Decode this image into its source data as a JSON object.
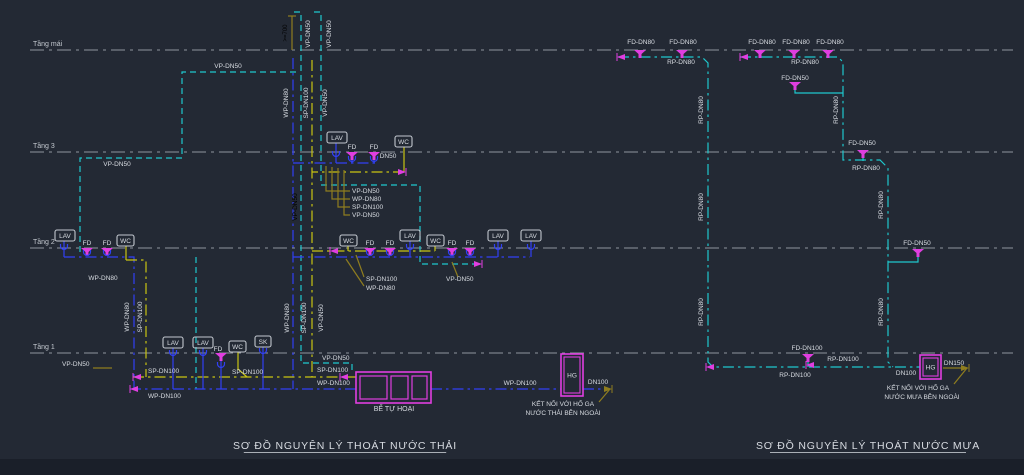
{
  "canvas": {
    "w": 1024,
    "h": 475,
    "bg": "#232934",
    "bottom_bar": {
      "y": 459,
      "h": 16,
      "color": "#1a1f29"
    }
  },
  "colors": {
    "cy": "#1ec8cd",
    "bl": "#3140f5",
    "yl": "#c9c412",
    "mg": "#e03ee0",
    "ol": "#8f7d1f",
    "w": "#d8dce2",
    "gr": "#8f959e",
    "grt": "#c3c8cf"
  },
  "dashes": {
    "d": "6,4",
    "dd": "11,4,2.5,4",
    "floor": "14,5,3,5"
  },
  "floors": [
    {
      "label": "Tầng mái",
      "y": 50
    },
    {
      "label": "Tầng 3",
      "y": 152
    },
    {
      "label": "Tầng 2",
      "y": 248
    },
    {
      "label": "Tầng 1",
      "y": 353
    }
  ],
  "titles": [
    {
      "t": "SƠ ĐỒ NGUYÊN LÝ THOÁT NƯỚC THẢI",
      "x": 345,
      "y": 449
    },
    {
      "t": "SƠ ĐỒ NGUYÊN LÝ THOÁT NƯỚC MƯA",
      "x": 868,
      "y": 449
    }
  ],
  "pipes": [
    {
      "c": "cy",
      "d": "d",
      "pts": [
        [
          294,
          12
        ],
        [
          301,
          12
        ],
        [
          301,
          363
        ],
        [
          352,
          363
        ],
        [
          352,
          372
        ]
      ]
    },
    {
      "c": "cy",
      "d": "d",
      "pts": [
        [
          314,
          12
        ],
        [
          321,
          12
        ],
        [
          321,
          185
        ]
      ]
    },
    {
      "c": "cy",
      "d": "d",
      "pts": [
        [
          321,
          185
        ],
        [
          420,
          185
        ],
        [
          420,
          264
        ],
        [
          480,
          264
        ]
      ]
    },
    {
      "c": "cy",
      "d": "d",
      "pts": [
        [
          296,
          72
        ],
        [
          182,
          72
        ],
        [
          182,
          158
        ],
        [
          80,
          158
        ],
        [
          80,
          252
        ]
      ]
    },
    {
      "c": "cy",
      "d": "d",
      "pts": [
        [
          196,
          257
        ],
        [
          196,
          389
        ]
      ]
    },
    {
      "c": "bl",
      "d": "dd",
      "pts": [
        [
          293,
          58
        ],
        [
          293,
          389
        ]
      ]
    },
    {
      "c": "yl",
      "d": "dd",
      "pts": [
        [
          312,
          60
        ],
        [
          312,
          377
        ]
      ]
    },
    {
      "c": "bl",
      "d": "dd",
      "pts": [
        [
          293,
          163
        ],
        [
          378,
          163
        ]
      ]
    },
    {
      "c": "bl",
      "d": "s",
      "pts": [
        [
          336,
          143
        ],
        [
          336,
          163
        ]
      ]
    },
    {
      "c": "bl",
      "d": "s",
      "pts": [
        [
          352,
          158
        ],
        [
          352,
          163
        ]
      ]
    },
    {
      "c": "bl",
      "d": "s",
      "pts": [
        [
          374,
          158
        ],
        [
          374,
          163
        ]
      ]
    },
    {
      "c": "yl",
      "d": "s",
      "pts": [
        [
          404,
          147
        ],
        [
          404,
          172
        ]
      ]
    },
    {
      "c": "yl",
      "d": "dd",
      "pts": [
        [
          404,
          172
        ],
        [
          312,
          172
        ]
      ]
    },
    {
      "c": "bl",
      "d": "s",
      "pts": [
        [
          64,
          241
        ],
        [
          64,
          257
        ]
      ]
    },
    {
      "c": "bl",
      "d": "dd",
      "pts": [
        [
          64,
          257
        ],
        [
          134,
          257
        ],
        [
          134,
          389
        ]
      ]
    },
    {
      "c": "yl",
      "d": "s",
      "pts": [
        [
          126,
          246
        ],
        [
          126,
          260
        ]
      ]
    },
    {
      "c": "yl",
      "d": "dd",
      "pts": [
        [
          126,
          260
        ],
        [
          146,
          260
        ],
        [
          146,
          377
        ]
      ]
    },
    {
      "c": "bl",
      "d": "dd",
      "pts": [
        [
          293,
          257
        ],
        [
          530,
          257
        ]
      ]
    },
    {
      "c": "bl",
      "d": "s",
      "pts": [
        [
          410,
          241
        ],
        [
          410,
          257
        ]
      ]
    },
    {
      "c": "bl",
      "d": "s",
      "pts": [
        [
          498,
          241
        ],
        [
          498,
          257
        ]
      ]
    },
    {
      "c": "bl",
      "d": "s",
      "pts": [
        [
          531,
          241
        ],
        [
          531,
          257
        ]
      ]
    },
    {
      "c": "yl",
      "d": "s",
      "pts": [
        [
          348,
          246
        ],
        [
          348,
          251
        ]
      ]
    },
    {
      "c": "yl",
      "d": "s",
      "pts": [
        [
          435,
          246
        ],
        [
          435,
          251
        ]
      ]
    },
    {
      "c": "yl",
      "d": "dd",
      "pts": [
        [
          312,
          251
        ],
        [
          435,
          251
        ]
      ]
    },
    {
      "c": "yl",
      "d": "dd",
      "pts": [
        [
          133,
          377
        ],
        [
          356,
          377
        ]
      ]
    },
    {
      "c": "bl",
      "d": "dd",
      "pts": [
        [
          130,
          389
        ],
        [
          356,
          389
        ]
      ]
    },
    {
      "c": "yl",
      "d": "s",
      "pts": [
        [
          238,
          352
        ],
        [
          238,
          369
        ],
        [
          247,
          377
        ]
      ]
    },
    {
      "c": "bl",
      "d": "s",
      "pts": [
        [
          263,
          347
        ],
        [
          263,
          389
        ]
      ]
    },
    {
      "c": "bl",
      "d": "s",
      "pts": [
        [
          173,
          348
        ],
        [
          173,
          389
        ]
      ]
    },
    {
      "c": "bl",
      "d": "s",
      "pts": [
        [
          203,
          348
        ],
        [
          203,
          389
        ]
      ]
    },
    {
      "c": "bl",
      "d": "s",
      "pts": [
        [
          221,
          361
        ],
        [
          221,
          389
        ]
      ]
    },
    {
      "c": "bl",
      "d": "dd",
      "pts": [
        [
          431,
          389
        ],
        [
          561,
          389
        ]
      ]
    },
    {
      "c": "bl",
      "d": "dd",
      "pts": [
        [
          583,
          389
        ],
        [
          610,
          389
        ]
      ]
    },
    {
      "c": "ol",
      "d": "s",
      "pts": [
        [
          610,
          389
        ],
        [
          599,
          402
        ]
      ]
    },
    {
      "c": "ol",
      "d": "s",
      "pts": [
        [
          292,
          16
        ],
        [
          292,
          50
        ]
      ]
    },
    {
      "c": "ol",
      "d": "s",
      "pts": [
        [
          288,
          16
        ],
        [
          296,
          16
        ]
      ]
    },
    {
      "c": "ol",
      "d": "s",
      "pts": [
        [
          350,
          191
        ],
        [
          326,
          191
        ],
        [
          326,
          166
        ]
      ]
    },
    {
      "c": "ol",
      "d": "s",
      "pts": [
        [
          350,
          199
        ],
        [
          332,
          199
        ],
        [
          332,
          167
        ]
      ]
    },
    {
      "c": "ol",
      "d": "s",
      "pts": [
        [
          350,
          207
        ],
        [
          338,
          207
        ],
        [
          338,
          168
        ]
      ]
    },
    {
      "c": "ol",
      "d": "s",
      "pts": [
        [
          350,
          215
        ],
        [
          344,
          215
        ],
        [
          344,
          170
        ]
      ]
    },
    {
      "c": "ol",
      "d": "s",
      "pts": [
        [
          364,
          277
        ],
        [
          356,
          255
        ]
      ]
    },
    {
      "c": "ol",
      "d": "s",
      "pts": [
        [
          364,
          286
        ],
        [
          346,
          259
        ]
      ]
    },
    {
      "c": "ol",
      "d": "s",
      "pts": [
        [
          458,
          277
        ],
        [
          452,
          262
        ]
      ]
    },
    {
      "c": "ol",
      "d": "s",
      "pts": [
        [
          93,
          368
        ],
        [
          112,
          368
        ]
      ]
    },
    {
      "c": "cy",
      "d": "dd",
      "pts": [
        [
          618,
          57
        ],
        [
          702,
          57
        ],
        [
          708,
          63
        ],
        [
          708,
          362
        ],
        [
          713,
          367
        ],
        [
          920,
          367
        ]
      ]
    },
    {
      "c": "cy",
      "d": "dd",
      "pts": [
        [
          740,
          57
        ],
        [
          838,
          57
        ],
        [
          843,
          62
        ],
        [
          843,
          160
        ],
        [
          880,
          160
        ],
        [
          888,
          168
        ],
        [
          888,
          362
        ],
        [
          893,
          367
        ]
      ]
    },
    {
      "c": "cy",
      "d": "s",
      "pts": [
        [
          795,
          90
        ],
        [
          795,
          93
        ],
        [
          843,
          93
        ]
      ]
    },
    {
      "c": "cy",
      "d": "s",
      "pts": [
        [
          863,
          158
        ],
        [
          863,
          161
        ]
      ]
    },
    {
      "c": "cy",
      "d": "s",
      "pts": [
        [
          918,
          257
        ],
        [
          918,
          262
        ],
        [
          888,
          262
        ]
      ]
    },
    {
      "c": "cy",
      "d": "s",
      "pts": [
        [
          808,
          362
        ],
        [
          808,
          367
        ]
      ]
    },
    {
      "c": "ol",
      "d": "s",
      "pts": [
        [
          943,
          368
        ],
        [
          967,
          368
        ]
      ]
    },
    {
      "c": "ol",
      "d": "s",
      "pts": [
        [
          967,
          368
        ],
        [
          954,
          384
        ]
      ]
    }
  ],
  "funnels": [
    {
      "x": 352,
      "y": 152
    },
    {
      "x": 374,
      "y": 152
    },
    {
      "x": 87,
      "y": 248
    },
    {
      "x": 107,
      "y": 248
    },
    {
      "x": 370,
      "y": 248
    },
    {
      "x": 390,
      "y": 248
    },
    {
      "x": 452,
      "y": 248
    },
    {
      "x": 470,
      "y": 248
    },
    {
      "x": 221,
      "y": 353
    },
    {
      "x": 640,
      "y": 50
    },
    {
      "x": 682,
      "y": 50
    },
    {
      "x": 760,
      "y": 50
    },
    {
      "x": 794,
      "y": 50
    },
    {
      "x": 828,
      "y": 50
    },
    {
      "x": 795,
      "y": 82
    },
    {
      "x": 863,
      "y": 150
    },
    {
      "x": 918,
      "y": 249
    },
    {
      "x": 808,
      "y": 354
    }
  ],
  "traps": [
    {
      "x": 336,
      "y": 153
    },
    {
      "x": 352,
      "y": 158
    },
    {
      "x": 374,
      "y": 158
    },
    {
      "x": 64,
      "y": 246
    },
    {
      "x": 87,
      "y": 252
    },
    {
      "x": 107,
      "y": 252
    },
    {
      "x": 370,
      "y": 252
    },
    {
      "x": 390,
      "y": 252
    },
    {
      "x": 410,
      "y": 246
    },
    {
      "x": 452,
      "y": 252
    },
    {
      "x": 470,
      "y": 252
    },
    {
      "x": 498,
      "y": 246
    },
    {
      "x": 531,
      "y": 246
    },
    {
      "x": 173,
      "y": 352
    },
    {
      "x": 203,
      "y": 352
    },
    {
      "x": 263,
      "y": 350
    },
    {
      "x": 221,
      "y": 364
    }
  ],
  "arrows": [
    {
      "x": 406,
      "y": 172,
      "d": "r"
    },
    {
      "x": 330,
      "y": 251,
      "d": "l"
    },
    {
      "x": 482,
      "y": 264,
      "d": "r"
    },
    {
      "x": 133,
      "y": 377,
      "d": "l"
    },
    {
      "x": 130,
      "y": 389,
      "d": "l"
    },
    {
      "x": 340,
      "y": 377,
      "d": "l"
    },
    {
      "x": 617,
      "y": 57,
      "d": "l"
    },
    {
      "x": 740,
      "y": 57,
      "d": "l"
    },
    {
      "x": 706,
      "y": 367,
      "d": "l"
    },
    {
      "x": 806,
      "y": 365,
      "d": "l"
    },
    {
      "x": 612,
      "y": 389,
      "d": "r",
      "c": "ol"
    },
    {
      "x": 969,
      "y": 368,
      "d": "r",
      "c": "ol"
    }
  ],
  "boxes": [
    {
      "t": "LAV",
      "x": 327,
      "y": 132,
      "w": 20
    },
    {
      "t": "WC",
      "x": 395,
      "y": 136,
      "w": 17
    },
    {
      "t": "LAV",
      "x": 55,
      "y": 230,
      "w": 20
    },
    {
      "t": "WC",
      "x": 117,
      "y": 235,
      "w": 17
    },
    {
      "t": "WC",
      "x": 340,
      "y": 235,
      "w": 17
    },
    {
      "t": "LAV",
      "x": 400,
      "y": 230,
      "w": 20
    },
    {
      "t": "WC",
      "x": 427,
      "y": 235,
      "w": 17
    },
    {
      "t": "LAV",
      "x": 488,
      "y": 230,
      "w": 20
    },
    {
      "t": "LAV",
      "x": 521,
      "y": 230,
      "w": 20
    },
    {
      "t": "LAV",
      "x": 163,
      "y": 337,
      "w": 20
    },
    {
      "t": "LAV",
      "x": 193,
      "y": 337,
      "w": 20
    },
    {
      "t": "WC",
      "x": 229,
      "y": 341,
      "w": 17
    },
    {
      "t": "SK",
      "x": 255,
      "y": 336,
      "w": 16
    }
  ],
  "tank": {
    "x": 356,
    "y": 372,
    "w": 75,
    "h": 31,
    "label": "BỂ TỰ HOẠI",
    "cells": [
      [
        360,
        376,
        27,
        23
      ],
      [
        391,
        376,
        17,
        23
      ],
      [
        412,
        376,
        15,
        23
      ]
    ]
  },
  "manholes": [
    {
      "x": 561,
      "y": 354,
      "w": 22,
      "h": 42,
      "label": "HG"
    },
    {
      "x": 920,
      "y": 355,
      "w": 21,
      "h": 24,
      "label": "HG"
    }
  ],
  "labels": [
    {
      "t": ">=700",
      "x": 287,
      "y": 33,
      "r": -90,
      "c": "ol",
      "fs": 6
    },
    {
      "t": "VP-DN50",
      "x": 310,
      "y": 34,
      "r": -90
    },
    {
      "t": "VP-DN50",
      "x": 331,
      "y": 34,
      "r": -90
    },
    {
      "t": "VP-DN50",
      "x": 228,
      "y": 68
    },
    {
      "t": "WP-DN80",
      "x": 288,
      "y": 103,
      "r": -90
    },
    {
      "t": "SP-DN100",
      "x": 308,
      "y": 103,
      "r": -90
    },
    {
      "t": "VP-DN50",
      "x": 327,
      "y": 103,
      "r": -90
    },
    {
      "t": "VP-DN50",
      "x": 117,
      "y": 166
    },
    {
      "t": "VP-DN50",
      "x": 297,
      "y": 207,
      "r": -90,
      "c": "cy"
    },
    {
      "t": "FD",
      "x": 352,
      "y": 149
    },
    {
      "t": "FD",
      "x": 374,
      "y": 149
    },
    {
      "t": "DN50",
      "x": 388,
      "y": 158
    },
    {
      "t": "VP-DN50",
      "x": 352,
      "y": 193,
      "a": "start"
    },
    {
      "t": "WP-DN80",
      "x": 352,
      "y": 201,
      "a": "start"
    },
    {
      "t": "SP-DN100",
      "x": 352,
      "y": 209,
      "a": "start"
    },
    {
      "t": "VP-DN50",
      "x": 352,
      "y": 217,
      "a": "start"
    },
    {
      "t": "FD",
      "x": 87,
      "y": 245
    },
    {
      "t": "FD",
      "x": 107,
      "y": 245
    },
    {
      "t": "WP-DN80",
      "x": 103,
      "y": 280
    },
    {
      "t": "WP-DN80",
      "x": 129,
      "y": 317,
      "r": -90
    },
    {
      "t": "SP-DN100",
      "x": 142,
      "y": 317,
      "r": -90
    },
    {
      "t": "WP-DN80",
      "x": 289,
      "y": 318,
      "r": -90
    },
    {
      "t": "SP-DN100",
      "x": 306,
      "y": 318,
      "r": -90
    },
    {
      "t": "VP-DN50",
      "x": 323,
      "y": 318,
      "r": -90
    },
    {
      "t": "FD",
      "x": 370,
      "y": 245
    },
    {
      "t": "FD",
      "x": 390,
      "y": 245
    },
    {
      "t": "FD",
      "x": 452,
      "y": 245
    },
    {
      "t": "FD",
      "x": 470,
      "y": 245
    },
    {
      "t": "SP-DN100",
      "x": 366,
      "y": 281,
      "a": "start"
    },
    {
      "t": "WP-DN80",
      "x": 366,
      "y": 290,
      "a": "start"
    },
    {
      "t": "VP-DN50",
      "x": 446,
      "y": 281,
      "a": "start"
    },
    {
      "t": "FD",
      "x": 218,
      "y": 351
    },
    {
      "t": "VP-DN50",
      "x": 62,
      "y": 366,
      "a": "start"
    },
    {
      "t": "SP-DN100",
      "x": 148,
      "y": 373,
      "a": "start"
    },
    {
      "t": "SP-DN100",
      "x": 232,
      "y": 374,
      "a": "start"
    },
    {
      "t": "WP-DN100",
      "x": 148,
      "y": 398,
      "a": "start"
    },
    {
      "t": "VP-DN50",
      "x": 322,
      "y": 360,
      "a": "start"
    },
    {
      "t": "SP-DN100",
      "x": 317,
      "y": 372,
      "a": "start"
    },
    {
      "t": "WP-DN100",
      "x": 317,
      "y": 385,
      "a": "start"
    },
    {
      "t": "BỂ TỰ HOẠI",
      "x": 394,
      "y": 411,
      "fs": 7
    },
    {
      "t": "WP-DN100",
      "x": 520,
      "y": 385
    },
    {
      "t": "DN100",
      "x": 598,
      "y": 384
    },
    {
      "t": "KẾT NỐI VỚI HỐ GA",
      "x": 563,
      "y": 406
    },
    {
      "t": "NƯỚC THẢI BÊN NGOÀI",
      "x": 563,
      "y": 415
    },
    {
      "t": "FD-DN80",
      "x": 641,
      "y": 44
    },
    {
      "t": "FD-DN80",
      "x": 683,
      "y": 44
    },
    {
      "t": "RP-DN80",
      "x": 681,
      "y": 64
    },
    {
      "t": "RP-DN80",
      "x": 703,
      "y": 110,
      "r": -90
    },
    {
      "t": "RP-DN80",
      "x": 703,
      "y": 207,
      "r": -90
    },
    {
      "t": "RP-DN80",
      "x": 703,
      "y": 312,
      "r": -90
    },
    {
      "t": "FD-DN80",
      "x": 762,
      "y": 44
    },
    {
      "t": "FD-DN80",
      "x": 796,
      "y": 44
    },
    {
      "t": "FD-DN80",
      "x": 830,
      "y": 44
    },
    {
      "t": "RP-DN80",
      "x": 805,
      "y": 64
    },
    {
      "t": "FD-DN50",
      "x": 795,
      "y": 80
    },
    {
      "t": "RP-DN80",
      "x": 838,
      "y": 110,
      "r": -90
    },
    {
      "t": "FD-DN50",
      "x": 862,
      "y": 145
    },
    {
      "t": "RP-DN80",
      "x": 866,
      "y": 170
    },
    {
      "t": "RP-DN80",
      "x": 883,
      "y": 205,
      "r": -90
    },
    {
      "t": "RP-DN80",
      "x": 883,
      "y": 312,
      "r": -90
    },
    {
      "t": "FD-DN50",
      "x": 917,
      "y": 245
    },
    {
      "t": "FD-DN100",
      "x": 807,
      "y": 350
    },
    {
      "t": "RP-DN100",
      "x": 843,
      "y": 361
    },
    {
      "t": "RP-DN100",
      "x": 795,
      "y": 377
    },
    {
      "t": "DN100",
      "x": 906,
      "y": 375
    },
    {
      "t": "DN150",
      "x": 954,
      "y": 365
    },
    {
      "t": "KẾT NỐI VỚI HỐ GA",
      "x": 918,
      "y": 390
    },
    {
      "t": "NƯỚC MƯA BÊN NGOÀI",
      "x": 922,
      "y": 399
    }
  ]
}
